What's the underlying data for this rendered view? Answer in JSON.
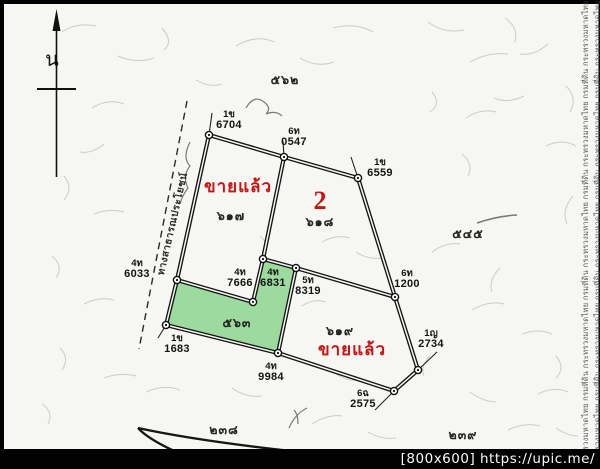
{
  "map": {
    "compass_label": "น",
    "road_label": "ทางสาธารณประโยชน์",
    "plots": {
      "plot_617": {
        "number_thai": "๖๑๗",
        "status": "ขายแล้ว"
      },
      "plot_618": {
        "number_thai": "๖๑๘",
        "big_number": "2"
      },
      "plot_563": {
        "number_thai": "๕๖๓",
        "fill": "#93d794"
      },
      "plot_619": {
        "number_thai": "๖๑๙",
        "status": "ขายแล้ว"
      }
    },
    "adjacent_numbers": {
      "top": "๕๖๒",
      "right": "๕๔๕",
      "bottom_left": "๒๓๘",
      "bottom_right": "๒๓๙"
    },
    "markers": [
      {
        "code": "1ข",
        "number": "6704"
      },
      {
        "code": "6ท",
        "number": "0547"
      },
      {
        "code": "1ข",
        "number": "6559"
      },
      {
        "code": "4ท",
        "number": "6033"
      },
      {
        "code": "4ท",
        "number": "7666"
      },
      {
        "code": "4ท",
        "number": "6831"
      },
      {
        "code": "5ท",
        "number": "8319"
      },
      {
        "code": "6ท",
        "number": "1200"
      },
      {
        "code": "1ญ",
        "number": "2734"
      },
      {
        "code": "6ฉ",
        "number": "2575"
      },
      {
        "code": "4ท",
        "number": "9984"
      },
      {
        "code": "1ข",
        "number": "1683"
      }
    ]
  },
  "watermark": {
    "bar_text": "[800x600] https://upic.me/",
    "side_text": "กระทรวงมหาดไทย กรมที่ดิน กระทรวงมหาดไทย กรมที่ดิน กระทรวงมหาดไทย กรมที่ดิน กระทรวงมหาดไทย กรมที่ดิน กระทรวงมหาดไทย กรมที่ดิน"
  },
  "colors": {
    "sold_red": "#cc1212",
    "plot_green": "#93d794",
    "paper": "#f6f6f2"
  }
}
